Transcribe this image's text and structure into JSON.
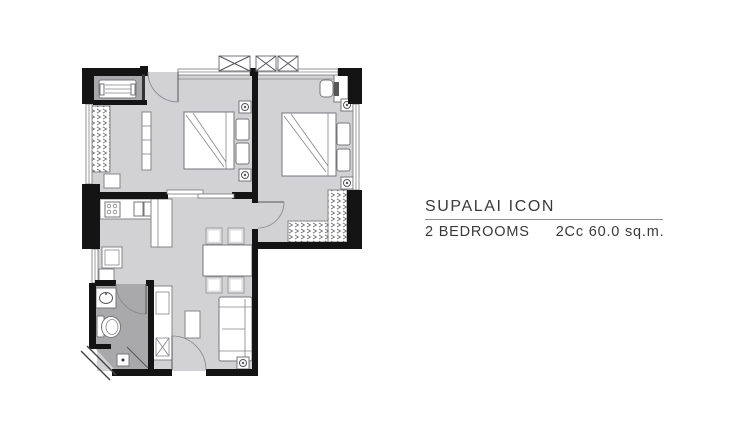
{
  "panel": {
    "project_title": "SUPALAI ICON",
    "unit_type": "2 BEDROOMS",
    "unit_code": "2Cc",
    "unit_area": "60.0 sq.m."
  },
  "colors": {
    "wall": "#141414",
    "floor": "#d2d2d4",
    "wet_floor": "#a9a9ab",
    "furniture_outline": "#85858a",
    "text": "#3a3a3a",
    "divider_line": "#8f8f8f"
  },
  "rooms": [
    "bedroom-1",
    "bedroom-2",
    "living-dining",
    "kitchen",
    "bathroom",
    "utility",
    "ac-ledge"
  ]
}
